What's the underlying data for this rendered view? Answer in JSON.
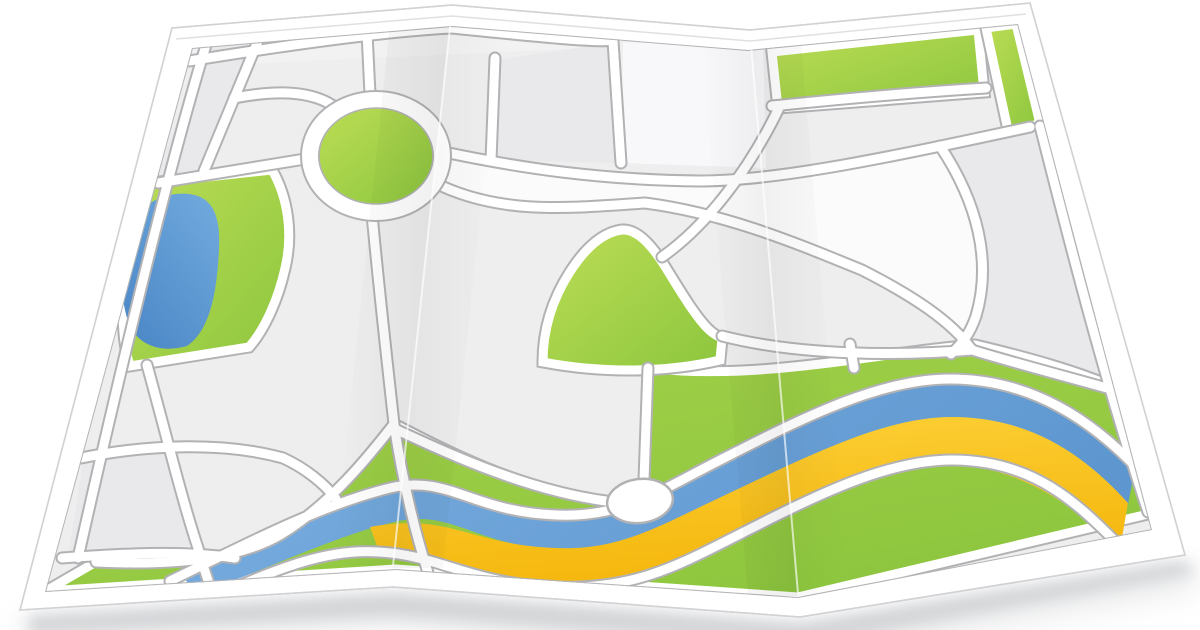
{
  "meta": {
    "title": "Folded street map illustration",
    "canvas_width": 1200,
    "canvas_height": 630,
    "background": "#ffffff",
    "text_content": "none"
  },
  "palette": {
    "paper": "#ffffff",
    "paper_edge": "#d2d2d5",
    "paper_fold_line": "#e0e0e3",
    "shadow": "#b9bcc0",
    "parcel_base": "#eeeeef",
    "parcel_light": "#fbfbfc",
    "parcel_lighter": "#f8f8fa",
    "parcel_dark": "#e9e9eb",
    "parcel_toprow": "#f2f2f3",
    "frame_line": "#b4b4b7",
    "road_casing": "#b2b2b5",
    "road_surface": "#ffffff",
    "green_light": "#bcdd55",
    "green_mid": "#a5d14a",
    "green_dark": "#8cc63e",
    "lake_light": "#6fa8dc",
    "lake_dark": "#4a86c6",
    "river_light": "#7bafe0",
    "river_dark": "#5e97d0",
    "sand_light": "#fdd23b",
    "sand_dark": "#f5b70d",
    "crease_shadow": "#000000",
    "crease_highlight": "rgba(255,255,255,0.65)"
  },
  "features": {
    "subject": "folded paper street map, icon style, perspective view with two vertical fold creases and drop shadow",
    "items": [
      {
        "name": "roundabout-island",
        "type": "green-area",
        "shape": "ellipse"
      },
      {
        "name": "park-with-lake",
        "type": "green-area",
        "contains": "blue lake"
      },
      {
        "name": "hill-green",
        "type": "green-area",
        "shape": "bell"
      },
      {
        "name": "river",
        "type": "waterway",
        "bands": [
          "blue water",
          "yellow sandbank"
        ]
      },
      {
        "name": "river-valley-green",
        "type": "green-area",
        "position": "bottom, full width"
      },
      {
        "name": "green-strip-top",
        "type": "green-area",
        "position": "top-right horizontal"
      },
      {
        "name": "green-strip-right",
        "type": "green-area",
        "position": "top-right vertical"
      },
      {
        "name": "plaza-oval",
        "type": "white oval on river"
      },
      {
        "name": "road-network",
        "type": "white roads with gray casing"
      },
      {
        "name": "city-blocks",
        "type": "gray parcels"
      }
    ],
    "fold_creases": 2,
    "interactive_elements": 0
  }
}
